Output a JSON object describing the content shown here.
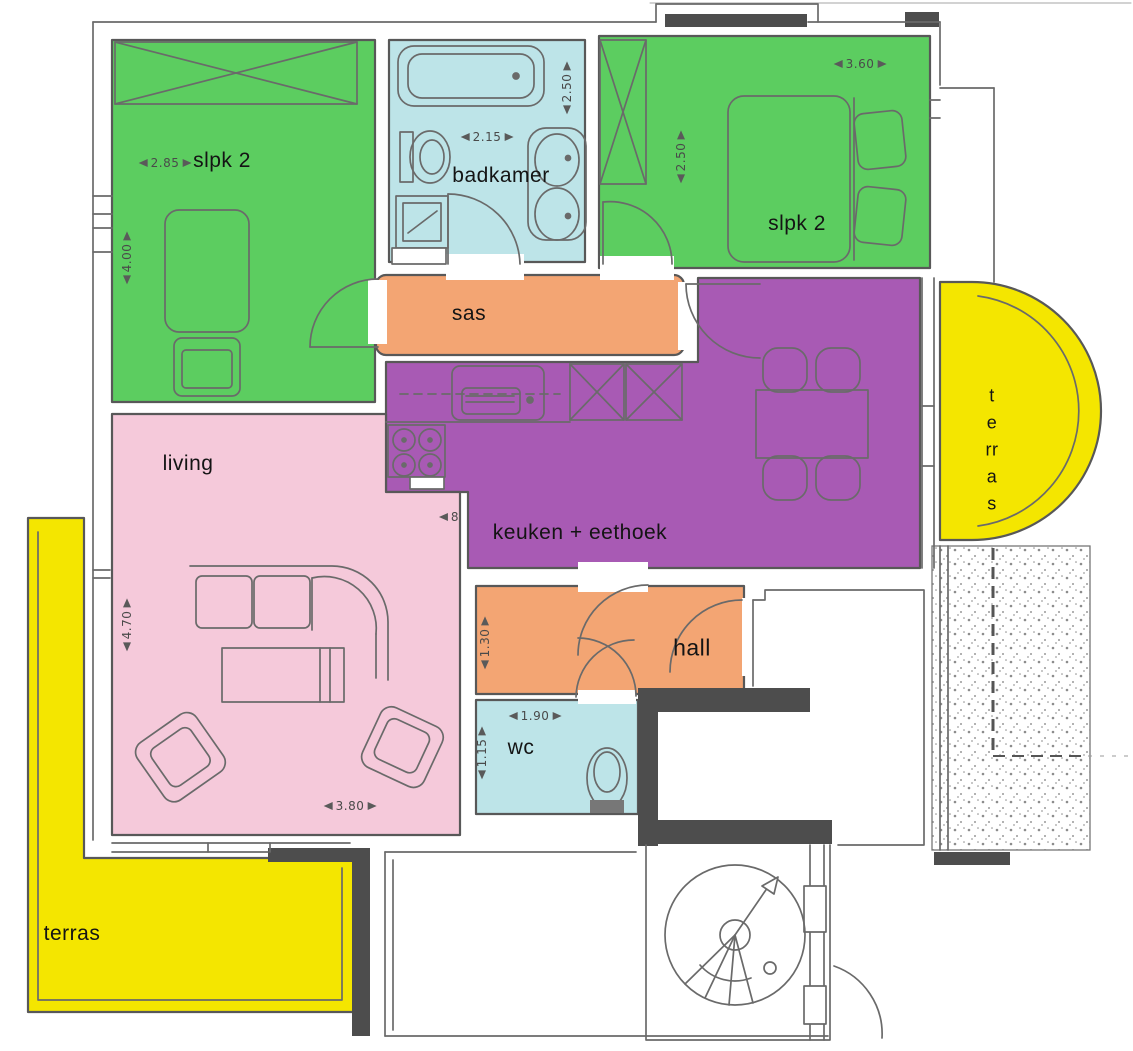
{
  "colors": {
    "bedroom_green": "#5ccd60",
    "bathroom_blue": "#bde4e8",
    "circulation_orange": "#f3a573",
    "kitchen_purple": "#a85ab4",
    "living_pink": "#f5c9da",
    "terrace_yellow": "#f4e600",
    "wall_dark": "#4d4d4d",
    "line_gray": "#6a6a6a"
  },
  "rooms": {
    "bedroom_left": {
      "label": "slpk 2",
      "width_m": "2.85",
      "depth_m": "4.00"
    },
    "bathroom": {
      "label": "badkamer",
      "width_m": "2.15",
      "depth_m": "2.50"
    },
    "bedroom_right": {
      "label": "slpk 2",
      "width_m": "3.60",
      "depth_m": "2.50"
    },
    "sas": {
      "label": "sas"
    },
    "kitchen_dining": {
      "label": "keuken + eethoek",
      "partial_dim": "8"
    },
    "living": {
      "label": "living",
      "width_m": "3.80",
      "depth_m": "4.70"
    },
    "hall": {
      "label": "hall",
      "depth_m": "1.30"
    },
    "wc": {
      "label": "wc",
      "width_m": "1.90",
      "depth_m": "1.15"
    },
    "terrace_side": {
      "label_stacked": "t\ne\nrr\na\ns"
    },
    "terrace_bottom": {
      "label": "terras"
    }
  }
}
